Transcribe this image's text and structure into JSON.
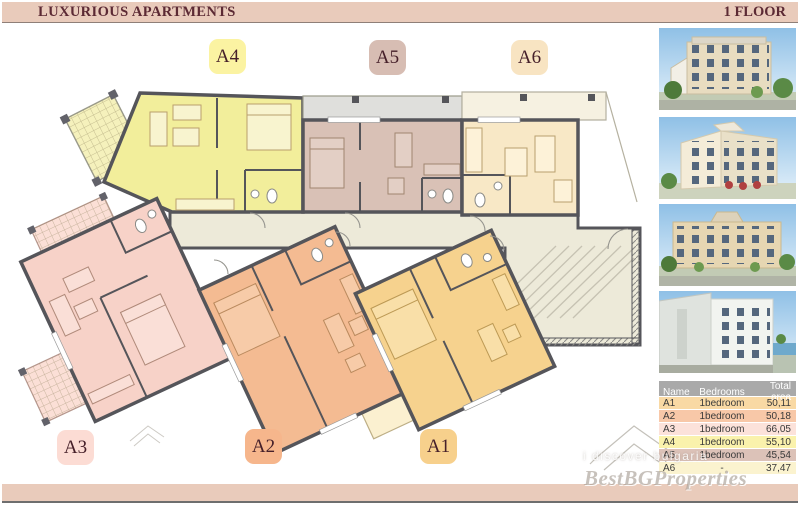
{
  "header": {
    "title": "LUXURIOUS APARTMENTS",
    "floor_label": "1 FLOOR"
  },
  "plan": {
    "apartments": [
      {
        "id": "a1",
        "label": "A1",
        "fill": "#f6d28e",
        "label_bg": "#f7d08c"
      },
      {
        "id": "a2",
        "label": "A2",
        "fill": "#f4bb92",
        "label_bg": "#f6b68c"
      },
      {
        "id": "a3",
        "label": "A3",
        "fill": "#f7d2c8",
        "label_bg": "#fcdcd4"
      },
      {
        "id": "a4",
        "label": "A4",
        "fill": "#f2ee9b",
        "label_bg": "#fbf3a2"
      },
      {
        "id": "a5",
        "label": "A5",
        "fill": "#d9c1b6",
        "label_bg": "#d7bdb3"
      },
      {
        "id": "a6",
        "label": "A6",
        "fill": "#f8e8c6",
        "label_bg": "#f8e4c2"
      }
    ],
    "common_area_color": "#edead9",
    "wall_color": "#55555a"
  },
  "sidebar": {
    "photos": [
      {
        "name": "building-photo-1",
        "description": "apartment building exterior render, front view"
      },
      {
        "name": "building-photo-2",
        "description": "apartment building exterior render, corner view"
      },
      {
        "name": "building-photo-3",
        "description": "apartment building exterior render, street view"
      },
      {
        "name": "building-photo-4",
        "description": "apartment building exterior render, seaside view"
      }
    ],
    "table": {
      "headers": [
        "Name",
        "Bedrooms",
        "Total area"
      ],
      "header_bg": "#a9a9a9",
      "rows": [
        {
          "name": "A1",
          "bedrooms": "1bedroom",
          "total_area": "50,11",
          "row_bg": "#f9d9a4"
        },
        {
          "name": "A2",
          "bedrooms": "1bedroom",
          "total_area": "50,18",
          "row_bg": "#f8c8a8"
        },
        {
          "name": "A3",
          "bedrooms": "1bedroom",
          "total_area": "66,05",
          "row_bg": "#fce2da"
        },
        {
          "name": "A4",
          "bedrooms": "1bedroom",
          "total_area": "55,10",
          "row_bg": "#faf2ac"
        },
        {
          "name": "A5",
          "bedrooms": "1bedroom",
          "total_area": "45,54",
          "row_bg": "#dcc2b8"
        },
        {
          "name": "A6",
          "bedrooms": "-",
          "total_area": "37,47",
          "row_bg": "#fbf3cf"
        }
      ]
    }
  },
  "watermarks": {
    "brand": "BestBGProperties",
    "tagline": "i discover bulgaria"
  },
  "colors": {
    "header_bg": "#e9cbbb",
    "header_text": "#5c2a34",
    "footer_bg": "#e9cdbd",
    "table_header_bg": "#a9a9a9"
  }
}
